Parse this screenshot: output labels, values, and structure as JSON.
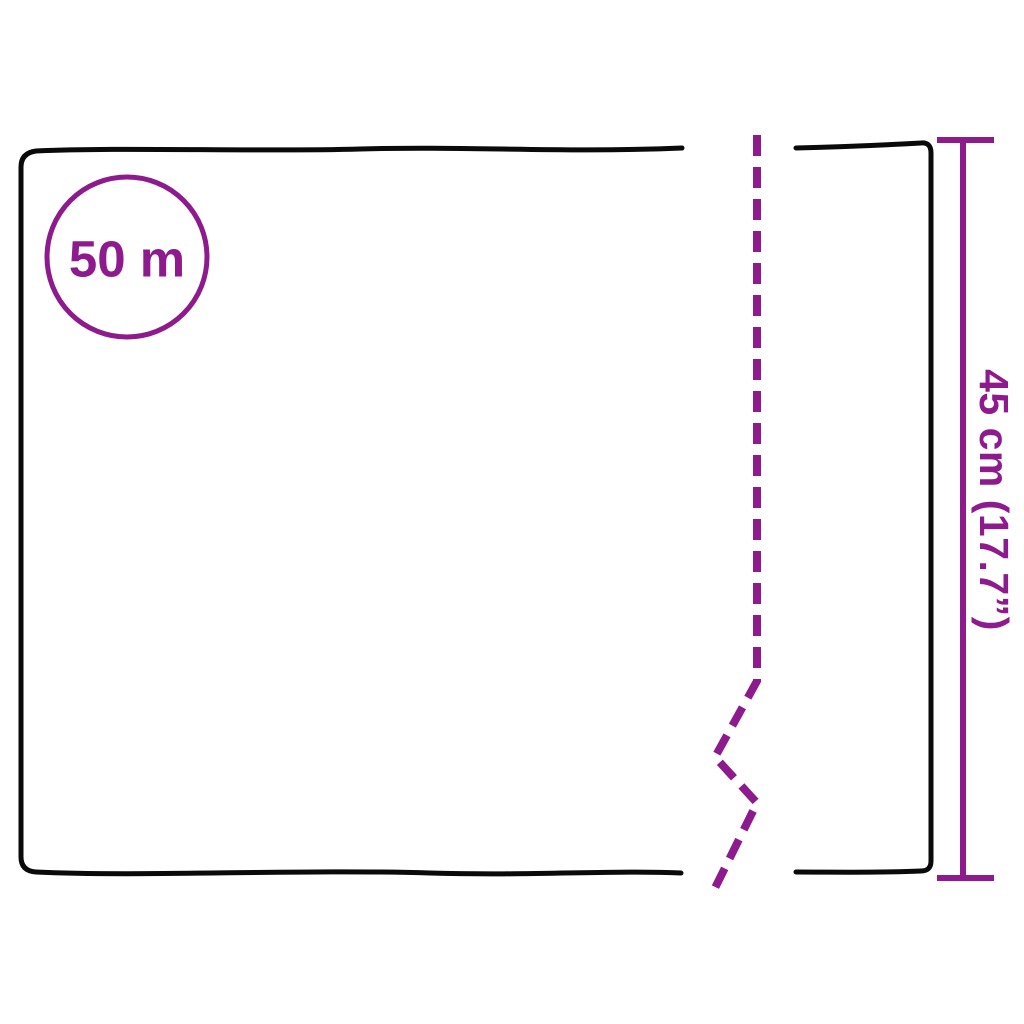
{
  "diagram": {
    "roll_length_label": "50 m",
    "height_label": "45 cm (17.7”)",
    "colors": {
      "outline": "#0a0a0a",
      "accent": "#8e1b8d",
      "background": "#ffffff"
    }
  }
}
